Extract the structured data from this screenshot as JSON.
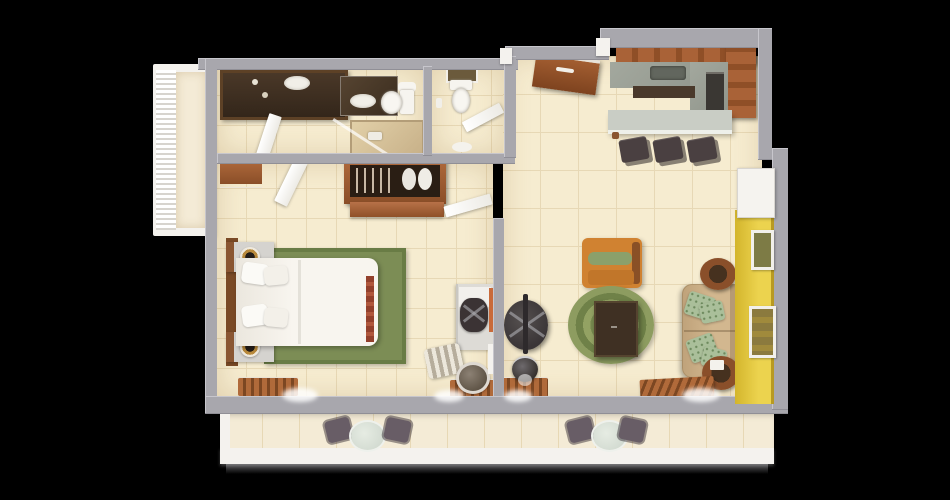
{
  "scene": {
    "kind": "3d-floor-plan-top-down-render",
    "background": "#000000",
    "palette": {
      "wall": "#a8a7ad",
      "wall_light": "#c7c6cc",
      "wall_shadow": "#908f96",
      "floor": "#f6ecd0",
      "grout": "#e7d8b5",
      "balcony_floor": "#f4ebd6",
      "white_trim": "#f4f2ee",
      "wood": "#a05c36",
      "wood_dark": "#7a4a26",
      "vanity_dark": "#3c2d20",
      "accent_yellow": "#e3c83d",
      "rug_green": "#7c8d55",
      "rug_green_dark": "#697c45",
      "bed_white": "#f4f1ea",
      "sofa_tan": "#c9ad86",
      "pillow_green": "#aabf9a",
      "chair_orange": "#d08231",
      "table_dark": "#3f3023",
      "counter_gray": "#9aa096",
      "bar_gray": "#c9cdc5",
      "stool_dark": "#4a4041",
      "balcony_chair": "#685d66",
      "balcony_table": "#ccd5cb",
      "lamp_gold": "#b98a3c"
    },
    "rooms": [
      "balcony-left",
      "bathroom",
      "wc",
      "closet",
      "bedroom",
      "living-room",
      "kitchen",
      "entry",
      "balcony-bottom"
    ],
    "furniture": {
      "bathroom": [
        "double-sink-vanity",
        "bathtub",
        "toilet",
        "swing-door",
        "towel"
      ],
      "wc": [
        "toilet",
        "wall-art",
        "swing-door",
        "bath-mat"
      ],
      "closet": [
        "hanging-rail",
        "garment-bags",
        "lower-cabinet",
        "swing-door"
      ],
      "bedroom": [
        "double-bed",
        "pillows",
        "headboard",
        "nightstand-north",
        "nightstand-south",
        "table-lamps",
        "green-area-rug",
        "slatted-bench",
        "dresser",
        "desk",
        "desk-chair",
        "striped-lounge-chair",
        "tv-console",
        "round-mirror"
      ],
      "living-room": [
        "entry-door",
        "sofa",
        "throw-pillows",
        "coffee-table",
        "round-green-rug",
        "orange-armchair",
        "side-table-north",
        "side-table-south",
        "round-dark-table",
        "console-with-lamp",
        "slatted-bench",
        "accent-wall",
        "wall-art-frames",
        "white-closet-panel"
      ],
      "kitchen": [
        "l-shaped-upper-cabinets",
        "gray-countertop",
        "sink",
        "cooktop",
        "dark-lower-counter",
        "breakfast-bar",
        "bar-stools"
      ],
      "balcony-bottom": [
        "cafe-table-sets",
        "white-railing"
      ],
      "balcony-left": [
        "lattice-railing"
      ]
    },
    "counts": {
      "bar_stools": 3,
      "cafe_sets": 2,
      "cafe_chairs": 4,
      "sofa_pillows": 4,
      "bed_pillows": 4,
      "wall_frames": 2,
      "hangers": 5
    }
  }
}
